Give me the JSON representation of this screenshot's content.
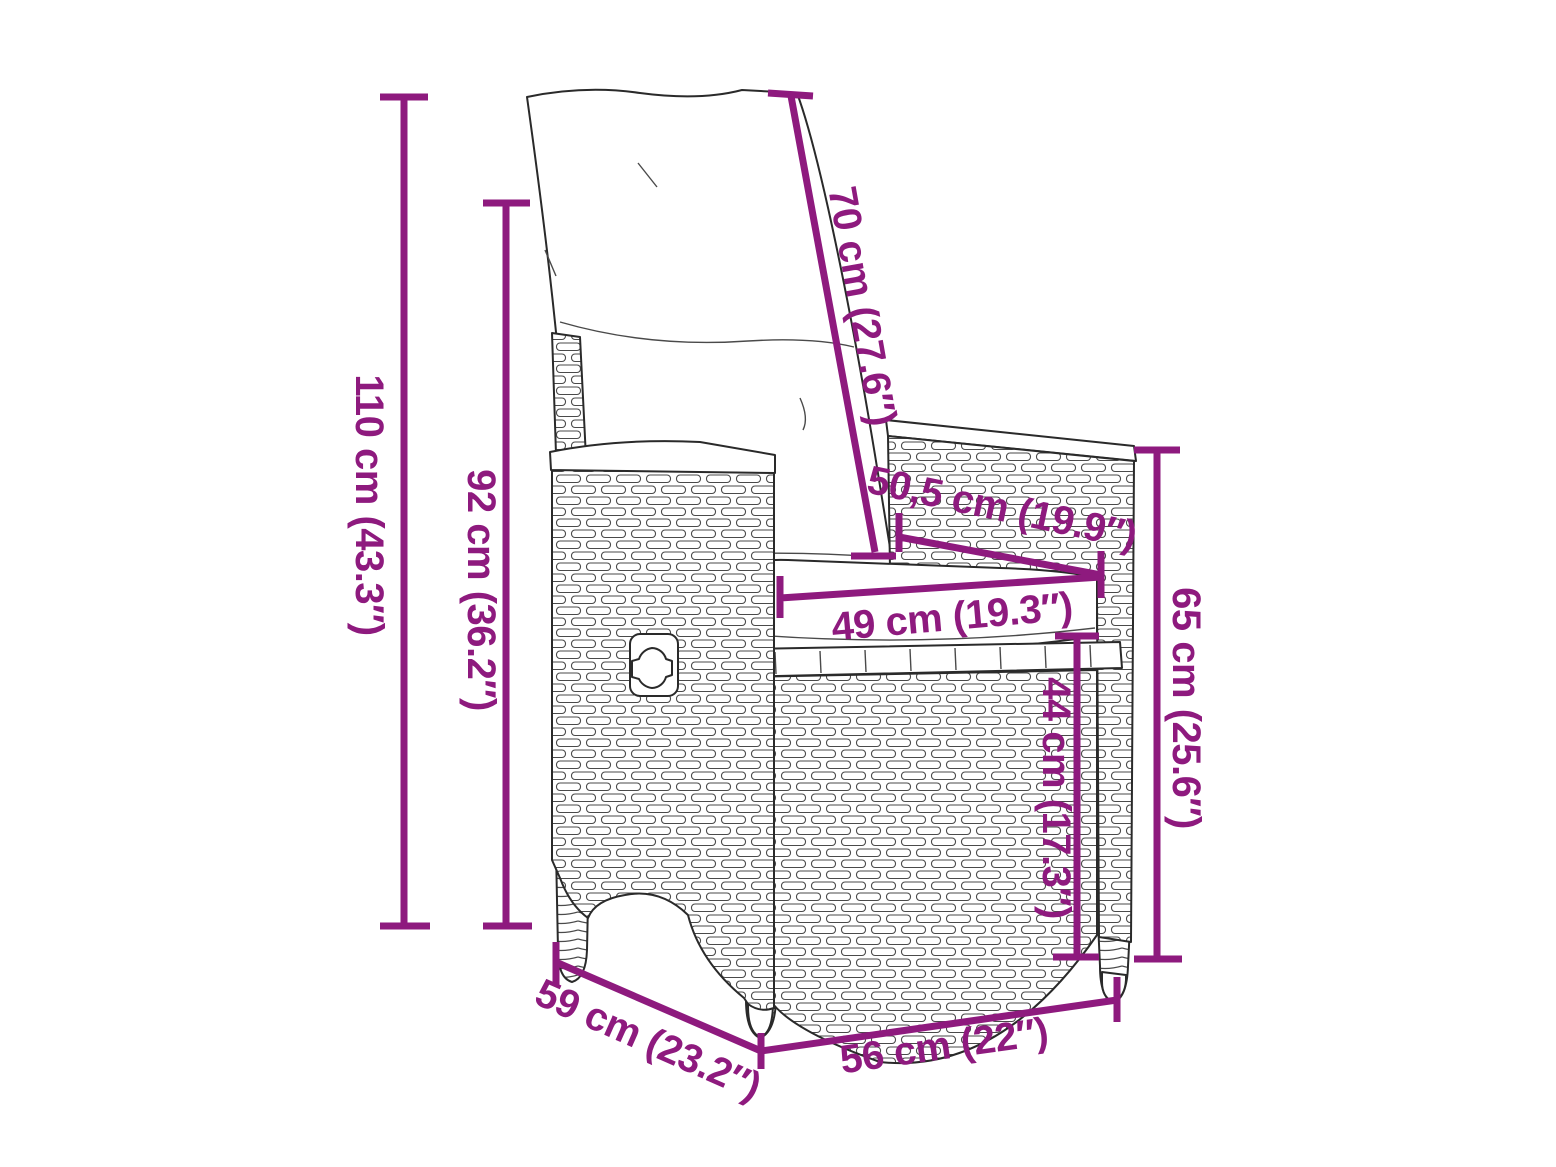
{
  "page": {
    "background": "#ffffff"
  },
  "diagram": {
    "type": "product-dimension-diagram",
    "product": "reclining-rattan-garden-chair-with-cushions",
    "accent_color": "#8e1a7e",
    "outline_color": "#2a2a2a",
    "dimensions": [
      {
        "id": "total-height",
        "cm": "110",
        "in": "43.3",
        "label": "110 cm (43.3″)",
        "orientation": "vertical"
      },
      {
        "id": "back-height",
        "cm": "92",
        "in": "36.2",
        "label": "92 cm (36.2″)",
        "orientation": "vertical"
      },
      {
        "id": "backrest-length",
        "cm": "70",
        "in": "27.6",
        "label": "70 cm (27.6″)",
        "orientation": "diagonal"
      },
      {
        "id": "seat-depth",
        "cm": "50,5",
        "in": "19.9",
        "label": "50,5 cm (19.9″)",
        "orientation": "diagonal"
      },
      {
        "id": "seat-width",
        "cm": "49",
        "in": "19.3",
        "label": "49 cm (19.3″)",
        "orientation": "horizontal"
      },
      {
        "id": "armrest-height",
        "cm": "65",
        "in": "25.6",
        "label": "65 cm (25.6″)",
        "orientation": "vertical"
      },
      {
        "id": "seat-height",
        "cm": "44",
        "in": "17.3",
        "label": "44 cm (17.3″)",
        "orientation": "vertical"
      },
      {
        "id": "seat-depth-outer",
        "cm": "59",
        "in": "23.2",
        "label": "59 cm (23.2″)",
        "orientation": "diagonal"
      },
      {
        "id": "width",
        "cm": "56",
        "in": "22",
        "label": "56 cm (22″)",
        "orientation": "horizontal"
      }
    ]
  }
}
